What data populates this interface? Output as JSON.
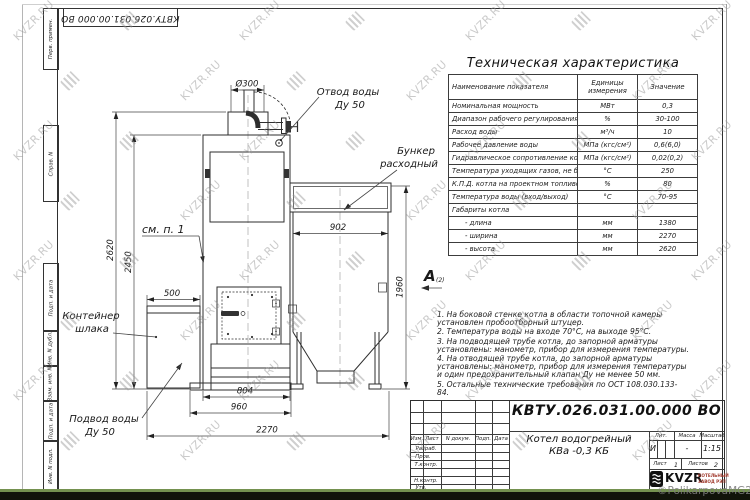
{
  "watermark": {
    "text": "KVZR.RU",
    "copyright": "©PolikarpovaMG2021"
  },
  "stamp_box": {
    "doc_number_rotated": "КВТУ.026.031.00.000 ВО"
  },
  "margin_fields": [
    "Перв. примен.",
    "Справ. N",
    "Подп. и дата",
    "Инв. N дубл.",
    "Взам. инв. N",
    "Подп. и дата",
    "Инв. N подл."
  ],
  "drawing": {
    "dims": {
      "d300": "Ø300",
      "w902": "902",
      "h1960": "1960",
      "h2620": "2620",
      "h2450": "2450",
      "w500": "500",
      "w804": "804",
      "w960": "960",
      "w2270": "2270"
    },
    "labels": {
      "outlet_line1": "Отвод воды",
      "outlet_line2": "Ду 50",
      "bunker_line1": "Бункер",
      "bunker_line2": "расходный",
      "see_note": "см. п. 1",
      "container_line1": "Контейнер",
      "container_line2": "шлака",
      "inlet_line1": "Подвод воды",
      "inlet_line2": "Ду 50",
      "view_marker": "А",
      "view_marker_sub": "(2)"
    }
  },
  "spec_table": {
    "title": "Техническая характеристика",
    "headers": [
      "Наименование показателя",
      "Единицы измерения",
      "Значение"
    ],
    "rows": [
      [
        "Номинальная мощность",
        "МВт",
        "0,3"
      ],
      [
        "Диапазон рабочего регулирования",
        "%",
        "30-100"
      ],
      [
        "Расход воды",
        "м³/ч",
        "10"
      ],
      [
        "Рабочее давление воды",
        "МПа (кгс/см²)",
        "0,6(6,0)"
      ],
      [
        "Гидравлическое сопротивление котла",
        "МПа (кгс/см²)",
        "0,02(0,2)"
      ],
      [
        "Температура уходящих газов, не более",
        "°С",
        "250"
      ],
      [
        "К.П.Д. котла на проектном топливе",
        "%",
        "80"
      ],
      [
        "Температура воды (вход/выход)",
        "°С",
        "70-95"
      ],
      [
        "Габариты котла",
        "",
        ""
      ],
      [
        "      - длина",
        "мм",
        "1380"
      ],
      [
        "      - ширина",
        "мм",
        "2270"
      ],
      [
        "      - высота",
        "мм",
        "2620"
      ]
    ]
  },
  "notes": {
    "items": [
      "1.  На боковой стенке котла в области топочной камеры установлен пробоотборный штуцер.",
      "2.  Температура воды на входе  70°С, на выходе  95°С.",
      "3.  На подводящей трубе котла, до запорной арматуры установлены: манометр, прибор для измерения температуры.",
      "4.  На отводящей трубе котла, до запорной арматуры установлены: манометр, прибор для измерения температуры и один предохранительный клапан Ду не менее 50 мм.",
      "5.  Остальные технические требования по ОСТ 108.030.133-84."
    ]
  },
  "title_block": {
    "doc_number": "КВТУ.026.031.00.000  ВО",
    "product_name_line1": "Котел водогрейный",
    "product_name_line2": "КВа -0,3  КБ",
    "col_headers": {
      "izm": "Изм.",
      "list": "Лист",
      "doc": "N докум.",
      "sign": "Подп.",
      "date": "Дата"
    },
    "row_labels": {
      "r1": "Разраб.",
      "r2": "Пров.",
      "r3": "Т.контр.",
      "r4": "Н.контр.",
      "r5": "Утв."
    },
    "lit_header": "Лит.",
    "mass_header": "Масса",
    "scale_header": "Масштаб",
    "lit_value": "И",
    "mass_value": "-",
    "scale_value": "1:15",
    "sheet_label": "Лист",
    "sheet_value": "1",
    "sheets_label": "Листов",
    "sheets_value": "2",
    "logo_text": "KVZR",
    "logo_caption_line1": "КОТЕЛЬНЫЙ",
    "logo_caption_line2": "ЗАВОД РЭП"
  }
}
